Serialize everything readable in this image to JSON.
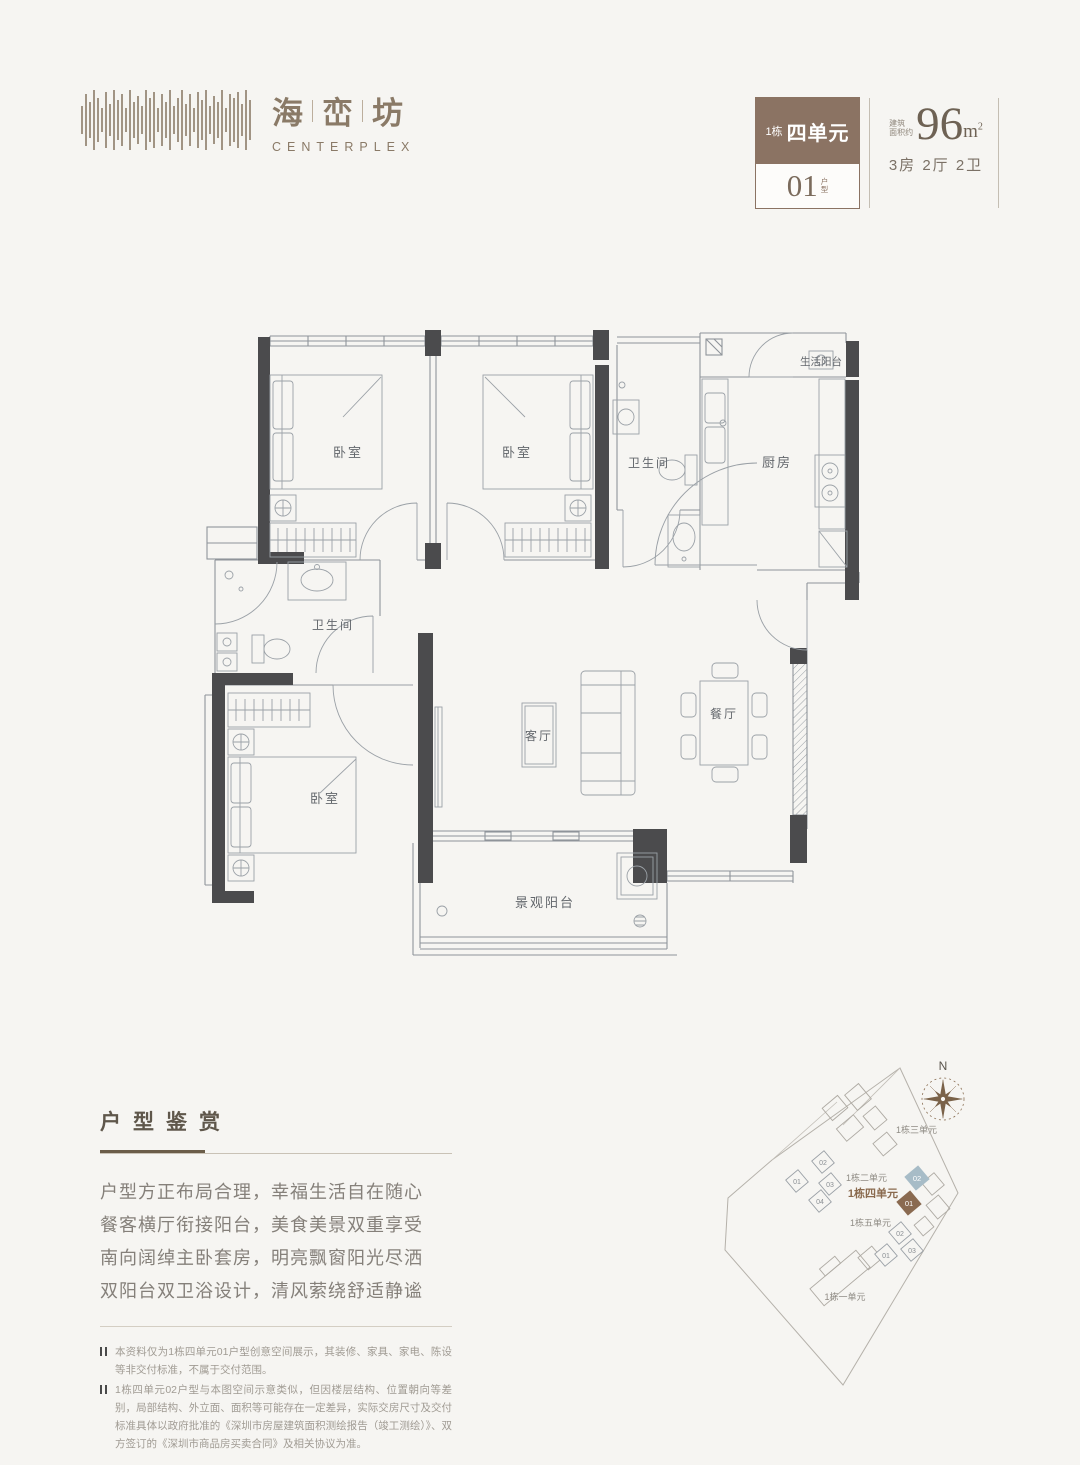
{
  "brand": {
    "chars": [
      "海",
      "峦",
      "坊"
    ],
    "name_en": "CENTERPLEX",
    "color": "#8a7a67"
  },
  "unit_card": {
    "building": "1栋",
    "unit": "四单元",
    "number": "01",
    "number_label_chars": [
      "户",
      "型"
    ],
    "area_prefix_lines": [
      "建筑",
      "面积约"
    ],
    "area_value": "96",
    "area_unit": "m",
    "area_power": "2",
    "layout": "3房 2厅 2卫",
    "badge_color": "#8b7363"
  },
  "plan": {
    "rooms": [
      {
        "label": "卧室"
      },
      {
        "label": "卧室"
      },
      {
        "label": "卫生间"
      },
      {
        "label": "厨房"
      },
      {
        "label": "生活阳台"
      },
      {
        "label": "卫生间"
      },
      {
        "label": "卧室"
      },
      {
        "label": "客厅"
      },
      {
        "label": "餐厅"
      },
      {
        "label": "景观阳台"
      }
    ],
    "wall_color": "#4b4b4d",
    "line_color": "#8f949a"
  },
  "appreciation": {
    "title": "户型鉴赏",
    "lines": [
      "户型方正布局合理，幸福生活自在随心",
      "餐客横厅衔接阳台，美食美景双重享受",
      "南向阔绰主卧套房，明亮飘窗阳光尽洒",
      "双阳台双卫浴设计，清风萦绕舒适静谧"
    ],
    "notes": [
      "本资料仅为1栋四单元01户型创意空间展示，其装修、家具、家电、陈设等非交付标准，不属于交付范围。",
      "1栋四单元02户型与本图空间示意类似，但因楼层结构、位置朝向等差别，局部结构、外立面、面积等可能存在一定差异，实际交房尺寸及交付标准具体以政府批准的《深圳市房屋建筑面积测绘报告（竣工测绘）》、双方签订的《深圳市商品房买卖合同》及相关协议为准。"
    ]
  },
  "sitemap": {
    "north": "N",
    "labels": {
      "b1": "1栋一单元",
      "b2": "1栋二单元",
      "b3": "1栋三单元",
      "b4": "1栋四单元",
      "b5": "1栋五单元"
    },
    "b2_units": [
      "01",
      "02",
      "03",
      "04"
    ],
    "b4_units": {
      "highlight": "01",
      "secondary": "02"
    },
    "b5_units": [
      "01",
      "02",
      "03"
    ],
    "colors": {
      "highlight": "#8a6a50",
      "secondary": "#a7bcc7",
      "label": "#8a6a4e",
      "compass": "#7a6249"
    }
  }
}
